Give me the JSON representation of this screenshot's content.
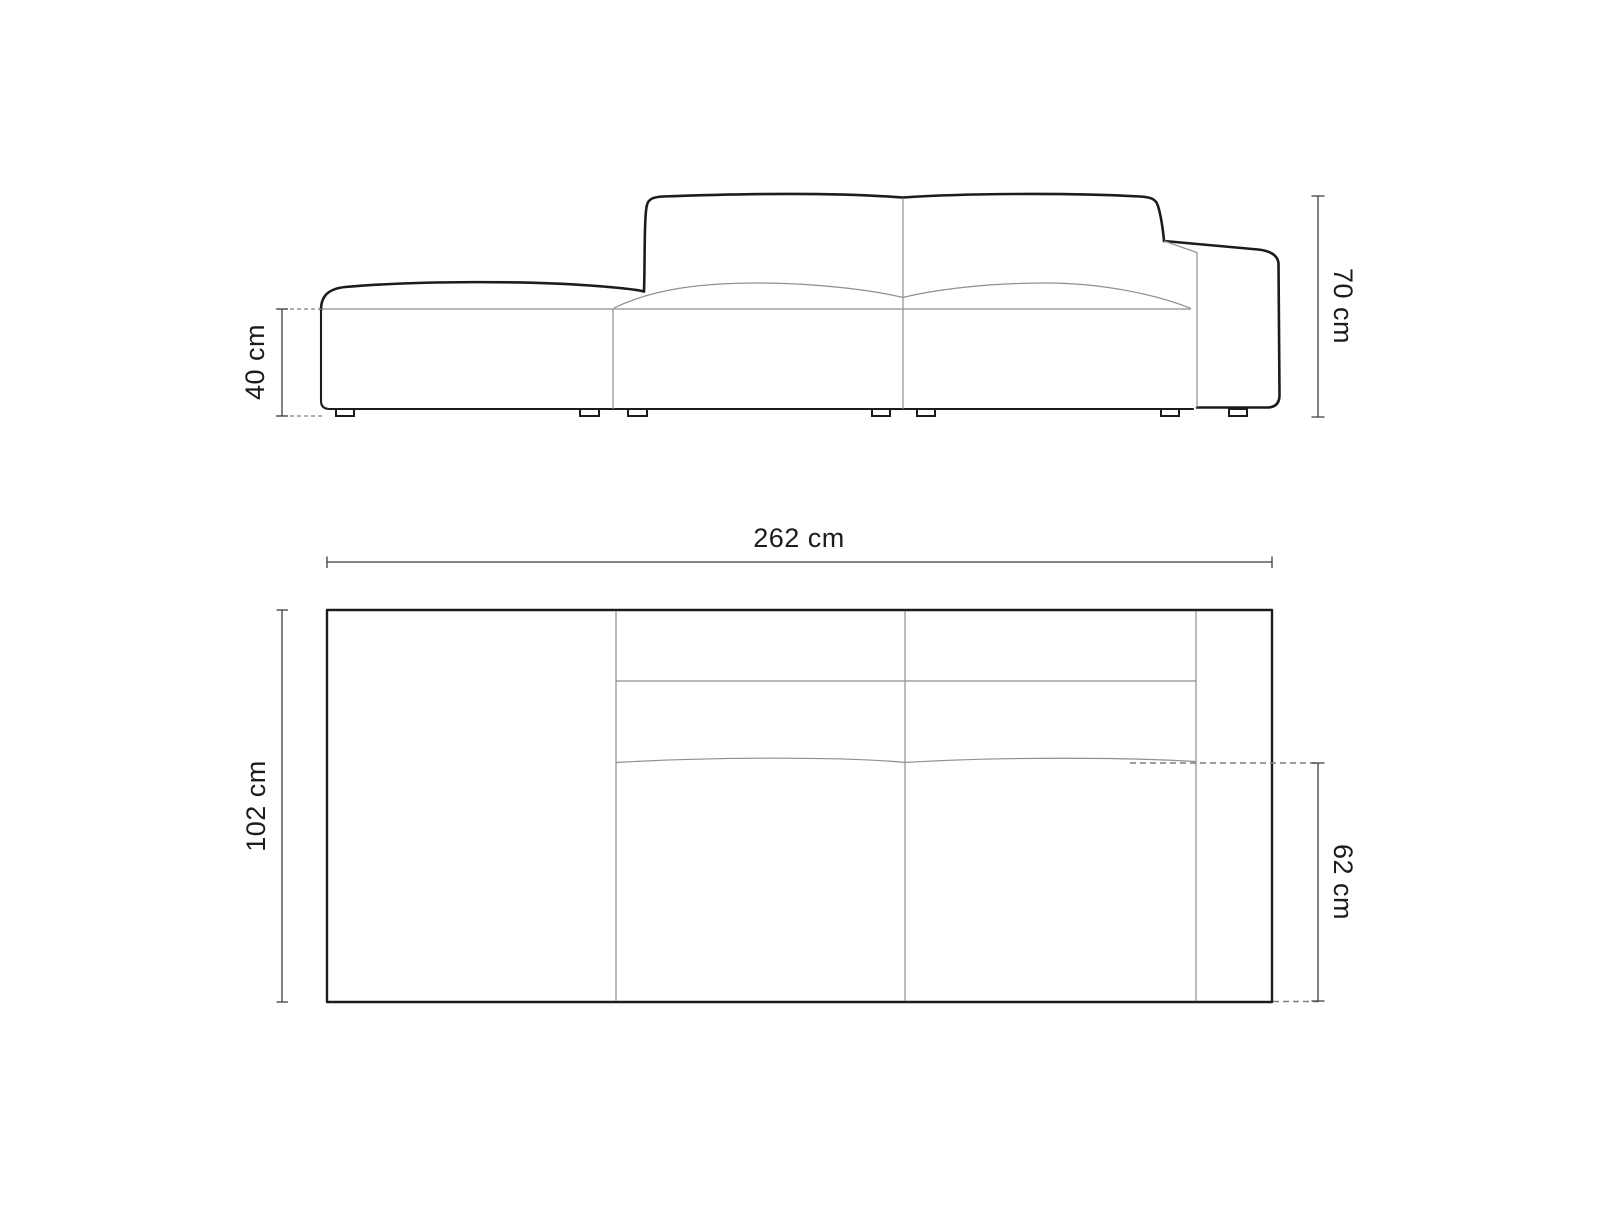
{
  "diagram": {
    "kind": "furniture-dimension-drawing",
    "subject": "modular sofa, open left end with right armrest, front elevation and top plan views",
    "units": "cm",
    "dimensions": {
      "front": [
        {
          "id": "seat-height",
          "label": "40 cm",
          "value_cm": 40
        },
        {
          "id": "overall-height",
          "label": "70 cm",
          "value_cm": 70
        }
      ],
      "top": [
        {
          "id": "overall-width",
          "label": "262 cm",
          "value_cm": 262
        },
        {
          "id": "overall-depth",
          "label": "102 cm",
          "value_cm": 102
        },
        {
          "id": "seat-depth",
          "label": "62 cm",
          "value_cm": 62
        }
      ]
    },
    "colors": {
      "outline": "#1c1c1c",
      "secondary_line": "#8f8f8f",
      "dimension_line": "#3c3c3c",
      "dashed_line": "#7d7d7d",
      "text": "#1c1c1c",
      "background": "#ffffff"
    }
  }
}
